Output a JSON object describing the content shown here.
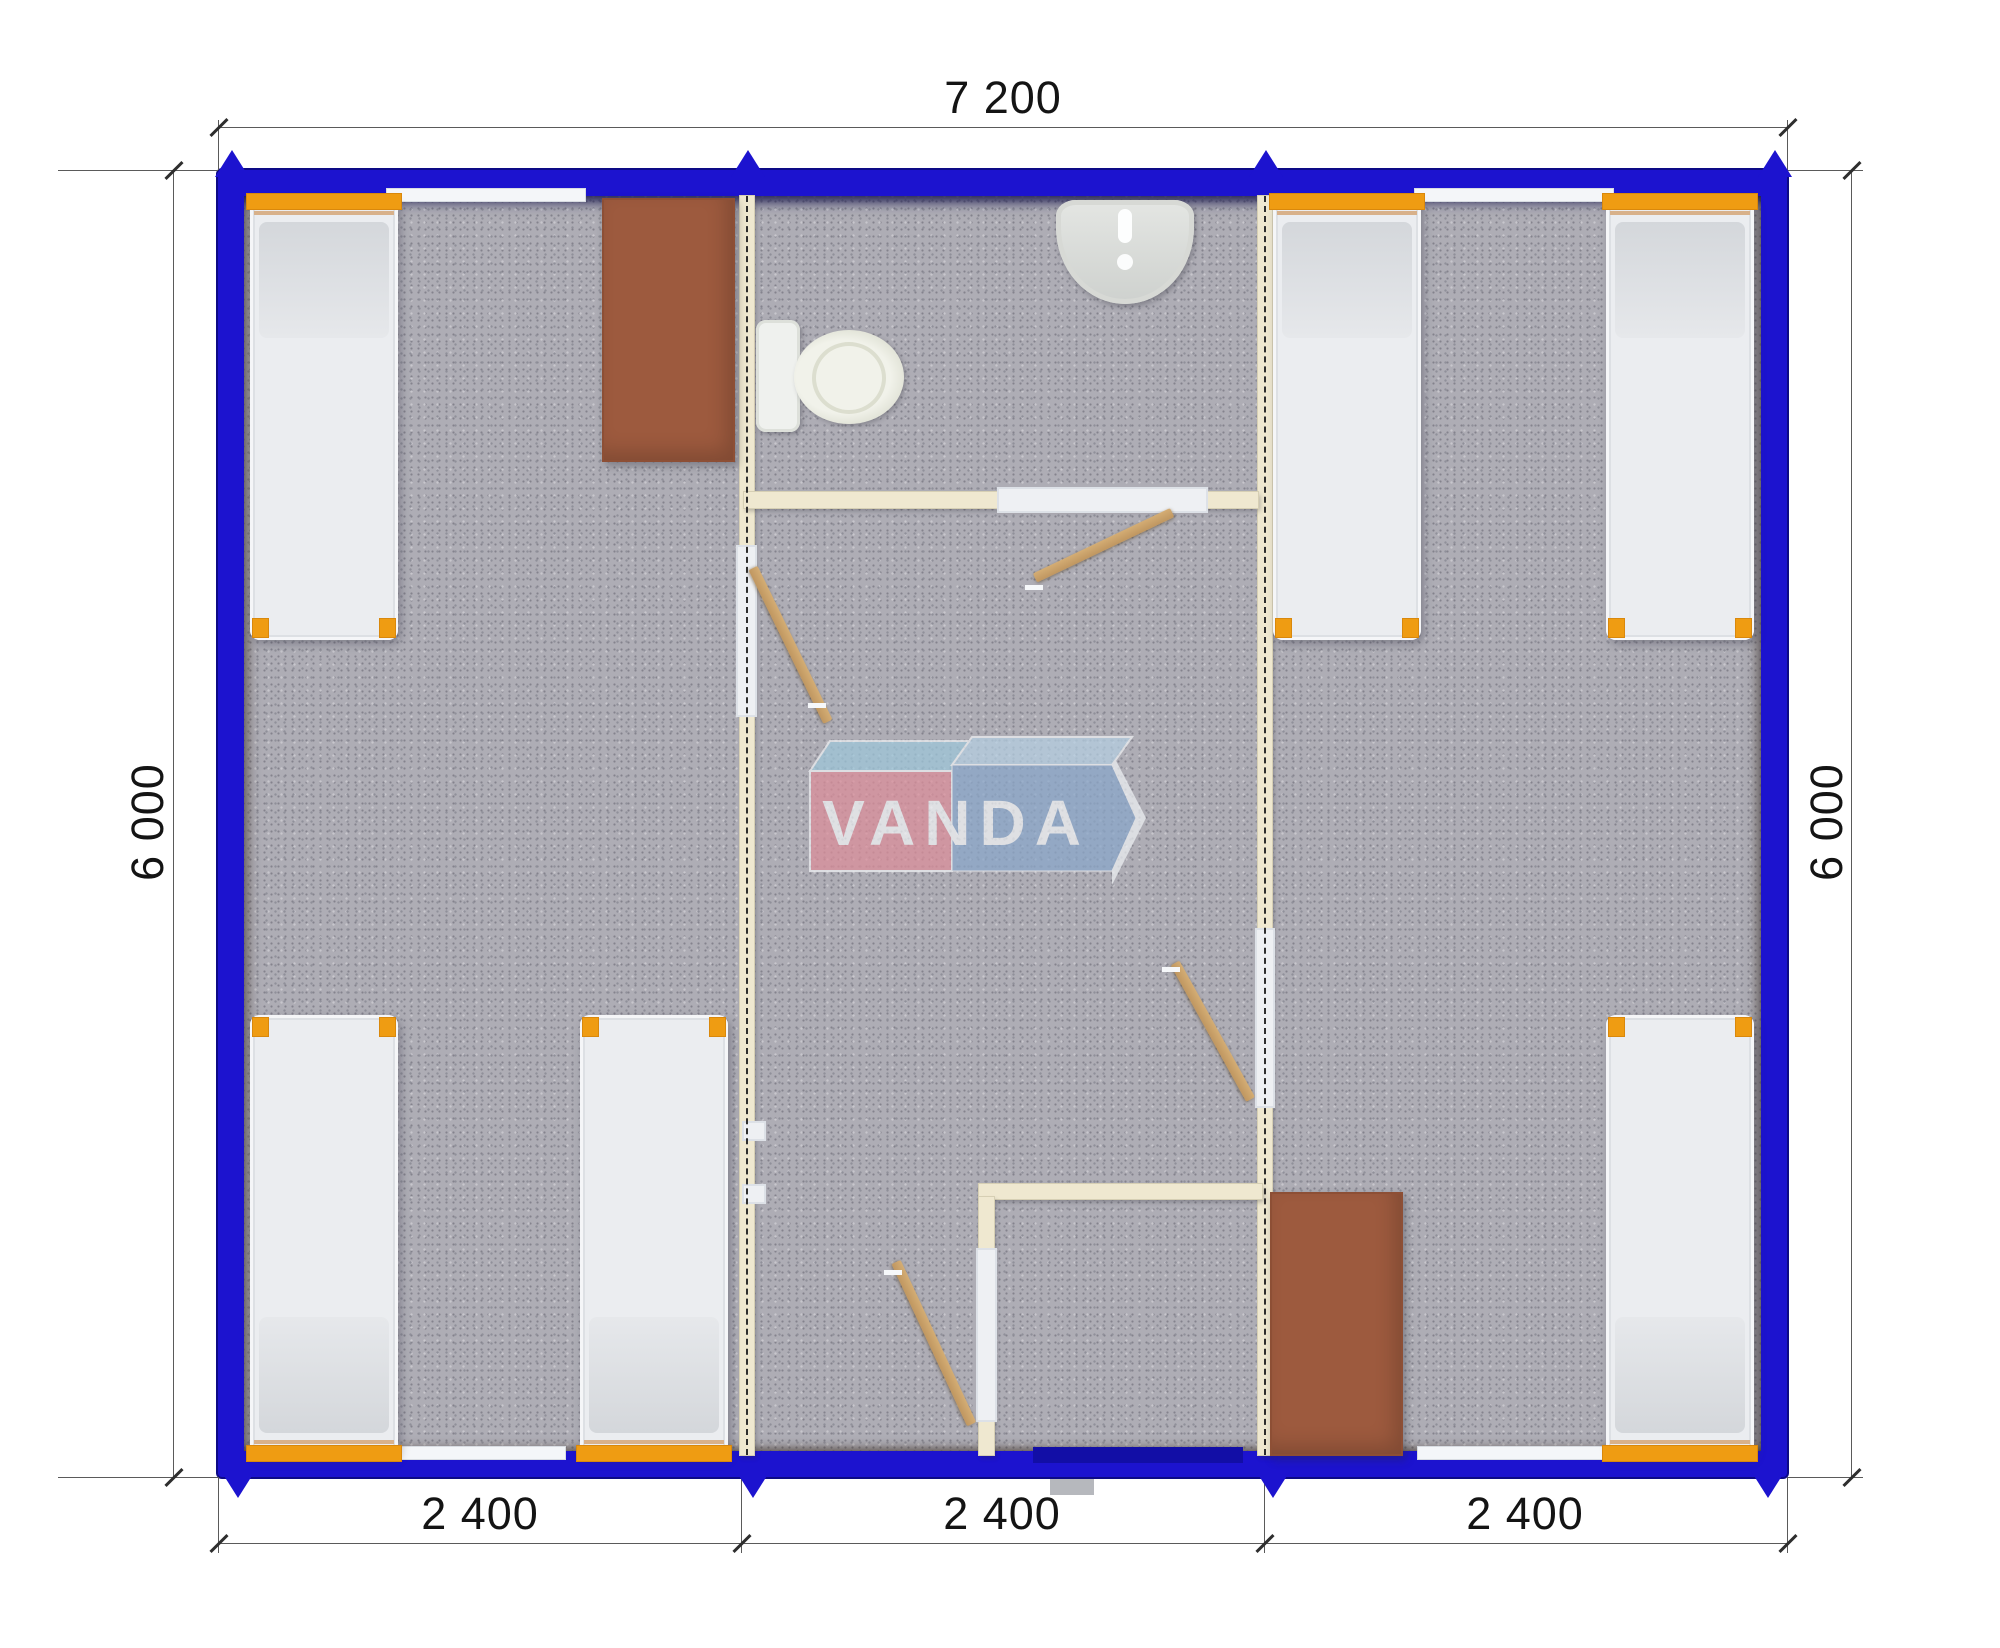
{
  "drawing": {
    "kind": "modular building floor plan, top view render",
    "modules": 3
  },
  "dims": {
    "top": "7 200",
    "bottom": [
      "2 400",
      "2 400",
      "2 400"
    ],
    "left": "6 000",
    "right": "6 000"
  },
  "logo": {
    "text": "VANDA",
    "red_face": "#dd8e9a",
    "blue_face": "#8aa7ca",
    "left_top_face": "#9ec7da",
    "right_top_face": "#b5cfe2",
    "text_color": "#f2f4f6"
  },
  "colors": {
    "wall_blue": "#1c13cf",
    "entrance_door_blue": "#120ea6",
    "floor_gray": "#aeadb5",
    "partition_cream": "#efe8d0",
    "door_wood": "#c9a26b",
    "wardrobe_brown": "#9d5a3e",
    "bed_frame_orange": "#ef9c12",
    "bed_mattress": "#ebedf0",
    "dimension_text": "#141414"
  },
  "plan": {
    "items": [
      {
        "type": "dline",
        "name": "dim-line-top",
        "x": 218,
        "y": 127,
        "w": 1569,
        "h": 1
      },
      {
        "type": "dline",
        "name": "dim-line-bottom",
        "x": 218,
        "y": 1543,
        "w": 1569,
        "h": 1
      },
      {
        "type": "dline",
        "name": "dim-line-left",
        "x": 173,
        "y": 170,
        "w": 1,
        "h": 1307
      },
      {
        "type": "dline",
        "name": "dim-line-right",
        "x": 1851,
        "y": 170,
        "w": 1,
        "h": 1307
      },
      {
        "type": "dline",
        "name": "ext-line",
        "x": 218,
        "y": 120,
        "w": 1,
        "h": 50
      },
      {
        "type": "dline",
        "name": "ext-line",
        "x": 1787,
        "y": 120,
        "w": 1,
        "h": 50
      },
      {
        "type": "dline",
        "name": "ext-line",
        "x": 58,
        "y": 170,
        "w": 160,
        "h": 1
      },
      {
        "type": "dline",
        "name": "ext-line",
        "x": 58,
        "y": 1477,
        "w": 160,
        "h": 1
      },
      {
        "type": "dline",
        "name": "ext-line",
        "x": 1787,
        "y": 170,
        "w": 76,
        "h": 1
      },
      {
        "type": "dline",
        "name": "ext-line",
        "x": 1787,
        "y": 1477,
        "w": 76,
        "h": 1
      },
      {
        "type": "dline",
        "name": "ext-line",
        "x": 218,
        "y": 1477,
        "w": 1,
        "h": 76
      },
      {
        "type": "dline",
        "name": "ext-line",
        "x": 741,
        "y": 1477,
        "w": 1,
        "h": 76
      },
      {
        "type": "dline",
        "name": "ext-line",
        "x": 1264,
        "y": 1477,
        "w": 1,
        "h": 76
      },
      {
        "type": "dline",
        "name": "ext-line",
        "x": 1787,
        "y": 1477,
        "w": 1,
        "h": 76
      },
      {
        "type": "tick",
        "name": "dim-tick",
        "x": 207,
        "y": 126
      },
      {
        "type": "tick",
        "name": "dim-tick",
        "x": 1776,
        "y": 126
      },
      {
        "type": "tick",
        "name": "dim-tick",
        "x": 207,
        "y": 1542
      },
      {
        "type": "tick",
        "name": "dim-tick",
        "x": 730,
        "y": 1542
      },
      {
        "type": "tick",
        "name": "dim-tick",
        "x": 1253,
        "y": 1542
      },
      {
        "type": "tick",
        "name": "dim-tick",
        "x": 1776,
        "y": 1542
      },
      {
        "type": "tick",
        "name": "dim-tick",
        "x": 162,
        "y": 169
      },
      {
        "type": "tick",
        "name": "dim-tick",
        "x": 162,
        "y": 1476
      },
      {
        "type": "tick",
        "name": "dim-tick",
        "x": 1840,
        "y": 169
      },
      {
        "type": "tick",
        "name": "dim-tick",
        "x": 1840,
        "y": 1476
      },
      {
        "type": "arrow-up",
        "name": "module-joint-marker",
        "x": 215,
        "y": 150
      },
      {
        "type": "arrow-up",
        "name": "module-joint-marker",
        "x": 731,
        "y": 150
      },
      {
        "type": "arrow-up",
        "name": "module-joint-marker",
        "x": 1249,
        "y": 150
      },
      {
        "type": "arrow-up",
        "name": "module-joint-marker",
        "x": 1758,
        "y": 150
      },
      {
        "type": "arrow-down",
        "name": "module-joint-marker",
        "x": 221,
        "y": 1471
      },
      {
        "type": "arrow-down",
        "name": "module-joint-marker",
        "x": 736,
        "y": 1471
      },
      {
        "type": "arrow-down",
        "name": "module-joint-marker",
        "x": 1256,
        "y": 1471
      },
      {
        "type": "arrow-down",
        "name": "module-joint-marker",
        "x": 1751,
        "y": 1471
      },
      {
        "type": "partition",
        "name": "module-wall-left",
        "x": 740,
        "y": 196,
        "w": 14,
        "h": 1259
      },
      {
        "type": "partition",
        "name": "module-wall-right",
        "x": 1258,
        "y": 196,
        "w": 14,
        "h": 1259
      },
      {
        "type": "wall",
        "name": "bathroom-wall",
        "x": 744,
        "y": 492,
        "w": 514,
        "h": 16
      },
      {
        "type": "wall",
        "name": "vestibule-wall-top",
        "x": 979,
        "y": 1184,
        "w": 283,
        "h": 15
      },
      {
        "type": "wall",
        "name": "vestibule-wall-left",
        "x": 979,
        "y": 1197,
        "w": 15,
        "h": 258
      },
      {
        "type": "opening",
        "name": "door-opening-room1",
        "x": 736,
        "y": 545,
        "w": 21,
        "h": 172
      },
      {
        "type": "opening",
        "name": "door-opening-bathroom",
        "x": 997,
        "y": 487,
        "w": 211,
        "h": 26
      },
      {
        "type": "opening",
        "name": "door-opening-room2",
        "x": 1255,
        "y": 928,
        "w": 20,
        "h": 180
      },
      {
        "type": "opening",
        "name": "door-opening-vestibule",
        "x": 976,
        "y": 1248,
        "w": 21,
        "h": 174
      },
      {
        "type": "opening",
        "name": "wall-stub",
        "x": 742,
        "y": 1121,
        "w": 24,
        "h": 20
      },
      {
        "type": "opening",
        "name": "wall-stub",
        "x": 742,
        "y": 1184,
        "w": 24,
        "h": 20
      },
      {
        "type": "dashline",
        "name": "module-axis",
        "x": 746,
        "y": 196,
        "w": 2,
        "h": 1259
      },
      {
        "type": "dashline",
        "name": "module-axis",
        "x": 1264,
        "y": 196,
        "w": 2,
        "h": 1259
      },
      {
        "type": "door",
        "name": "door-room1",
        "x": 753,
        "y": 563,
        "w": 171,
        "h": 10,
        "rot": 64
      },
      {
        "type": "door",
        "name": "door-bathroom",
        "x": 1035,
        "y": 573,
        "w": 152,
        "h": 10,
        "rot": -25.5
      },
      {
        "type": "door",
        "name": "door-room2",
        "x": 1175,
        "y": 958,
        "w": 156,
        "h": 10,
        "rot": 61
      },
      {
        "type": "door",
        "name": "door-entrance",
        "x": 896,
        "y": 1257,
        "w": 179,
        "h": 10,
        "rot": 65
      },
      {
        "type": "handle",
        "name": "door-handle",
        "x": 808,
        "y": 703,
        "w": 18,
        "h": 5
      },
      {
        "type": "handle",
        "name": "door-handle",
        "x": 1025,
        "y": 585,
        "w": 18,
        "h": 5
      },
      {
        "type": "handle",
        "name": "door-handle",
        "x": 1162,
        "y": 967,
        "w": 18,
        "h": 5
      },
      {
        "type": "handle",
        "name": "door-handle",
        "x": 884,
        "y": 1270,
        "w": 18,
        "h": 5
      },
      {
        "type": "window",
        "name": "window",
        "x": 386,
        "y": 188,
        "w": 200,
        "h": 14
      },
      {
        "type": "window",
        "name": "window",
        "x": 1414,
        "y": 188,
        "w": 200,
        "h": 14
      },
      {
        "type": "window",
        "name": "window",
        "x": 376,
        "y": 1446,
        "w": 190,
        "h": 14
      },
      {
        "type": "window",
        "name": "window",
        "x": 1417,
        "y": 1446,
        "w": 196,
        "h": 14
      },
      {
        "type": "door-exterior",
        "name": "entrance-door",
        "x": 1033,
        "y": 1447,
        "w": 210,
        "h": 16
      },
      {
        "type": "step",
        "name": "entrance-step",
        "x": 1050,
        "y": 1479,
        "w": 44,
        "h": 16
      },
      {
        "type": "bed",
        "name": "bed-1",
        "x": 250,
        "y": 198,
        "w": 148,
        "h": 442,
        "end": "top"
      },
      {
        "type": "bed",
        "name": "bed-2",
        "x": 250,
        "y": 1015,
        "w": 148,
        "h": 442,
        "end": "bottom"
      },
      {
        "type": "bed",
        "name": "bed-3",
        "x": 580,
        "y": 1015,
        "w": 148,
        "h": 442,
        "end": "bottom"
      },
      {
        "type": "bed",
        "name": "bed-4",
        "x": 1273,
        "y": 198,
        "w": 148,
        "h": 442,
        "end": "top"
      },
      {
        "type": "bed",
        "name": "bed-5",
        "x": 1606,
        "y": 198,
        "w": 148,
        "h": 442,
        "end": "top"
      },
      {
        "type": "bed",
        "name": "bed-6",
        "x": 1606,
        "y": 1015,
        "w": 148,
        "h": 442,
        "end": "bottom"
      },
      {
        "type": "wardrobe",
        "name": "wardrobe-1",
        "x": 602,
        "y": 198,
        "w": 133,
        "h": 264
      },
      {
        "type": "wardrobe",
        "name": "wardrobe-2",
        "x": 1270,
        "y": 1192,
        "w": 133,
        "h": 264
      },
      {
        "type": "toilet-tank",
        "name": "toilet-tank",
        "x": 756,
        "y": 320,
        "w": 44,
        "h": 112
      },
      {
        "type": "toilet-bowl",
        "name": "toilet-bowl",
        "x": 794,
        "y": 330,
        "w": 110,
        "h": 94
      },
      {
        "type": "sink",
        "name": "sink",
        "x": 1056,
        "y": 200,
        "w": 138,
        "h": 104
      }
    ]
  }
}
